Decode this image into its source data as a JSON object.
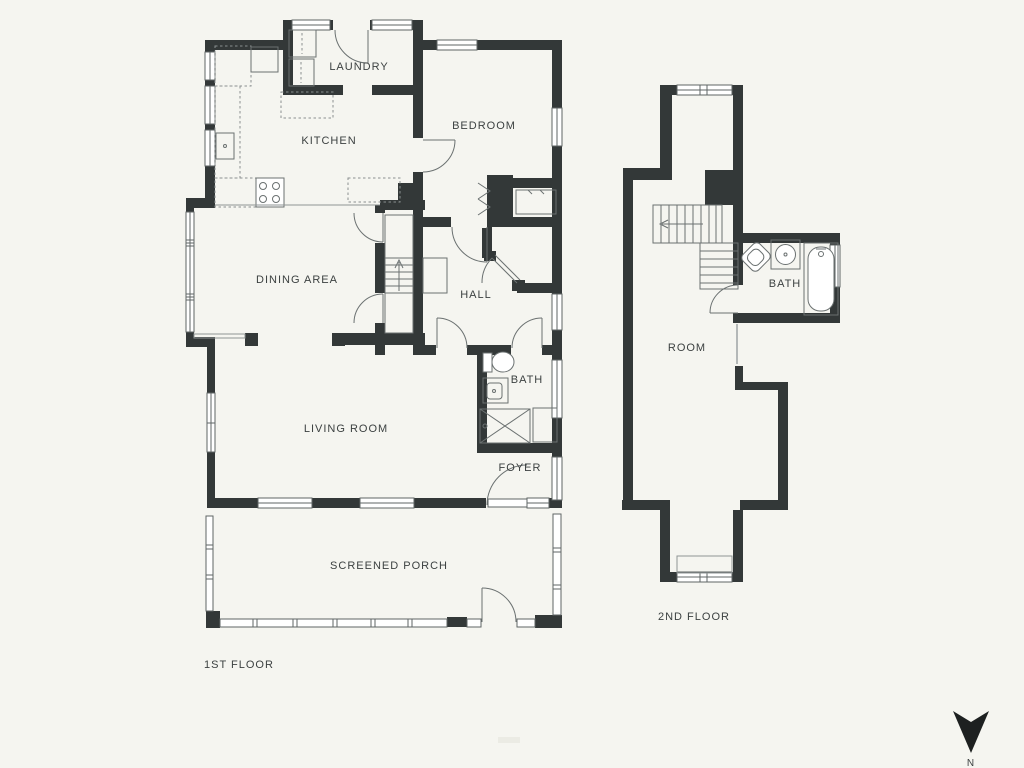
{
  "document_type": "floor-plan",
  "first_floor": {
    "title": "1ST FLOOR",
    "rooms": {
      "laundry": "LAUNDRY",
      "kitchen": "KITCHEN",
      "bedroom": "BEDROOM",
      "dining": "DINING AREA",
      "hall": "HALL",
      "bath": "BATH",
      "living": "LIVING ROOM",
      "foyer": "FOYER",
      "porch": "SCREENED PORCH"
    }
  },
  "second_floor": {
    "title": "2ND FLOOR",
    "rooms": {
      "bath": "BATH",
      "room": "ROOM"
    }
  },
  "compass": {
    "north": "N",
    "icon": "north-arrow-down"
  },
  "colors": {
    "background": "#f5f5f0",
    "wall": "#333838",
    "window_stroke": "#5f6565",
    "fixture_stroke": "#6b7171",
    "label_text": "#3c4141",
    "compass": "#1d2020"
  }
}
